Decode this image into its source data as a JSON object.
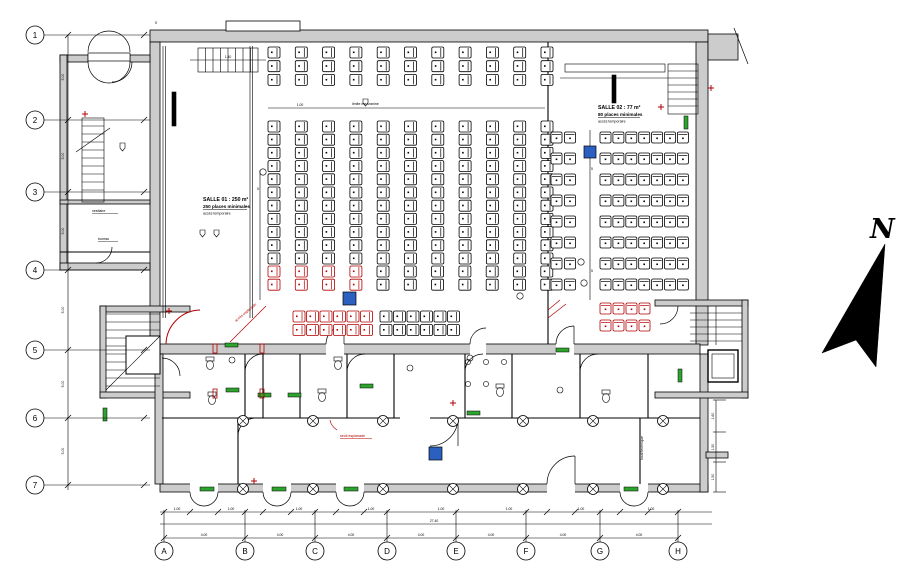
{
  "north": {
    "label": "N"
  },
  "rooms": {
    "salle01": {
      "l1": "SALLE 01 : 250 m²",
      "l2": "250 places minimales",
      "l3": "accès temporaire"
    },
    "salle02": {
      "l1": "SALLE 02 : 77 m²",
      "l2": "80 places minimales",
      "l3": "accès temporaire"
    },
    "room_small_1": "vestiaire",
    "room_small_2": "bureau",
    "mezz": "limite mezzanine",
    "tech": "local technique"
  },
  "notes": {
    "red_1": "accès esplanade",
    "red_2": "seuil esplanade"
  },
  "colors": {
    "wall": "#cccccc",
    "line": "#000000",
    "seat_red": "#b30000",
    "door_green": "#2fa32f",
    "marker_blue": "#2b5fc0"
  },
  "plan": {
    "axes": {
      "left": {
        "labels": [
          "1",
          "2",
          "3",
          "4",
          "5",
          "6",
          "7"
        ],
        "x": 35,
        "ys": [
          35,
          120,
          192,
          270,
          350,
          418,
          485
        ],
        "r": 9
      },
      "bottom": {
        "labels": [
          "A",
          "B",
          "C",
          "D",
          "E",
          "F",
          "G",
          "H"
        ],
        "y": 551,
        "xs": [
          164,
          245,
          315,
          387,
          456,
          526,
          600,
          678
        ],
        "r": 9
      }
    },
    "columns": {
      "xs": [
        243,
        313,
        383,
        453,
        523,
        593,
        663
      ],
      "ys": [
        421,
        489
      ],
      "r": 5.5
    },
    "seats": [
      {
        "x": 268,
        "y": 47,
        "cols": 11,
        "rows": 3,
        "dx": 27.3,
        "dy": 13.7,
        "w": 12,
        "h": 11,
        "dir": "v",
        "color": "black"
      },
      {
        "x": 268,
        "y": 121,
        "cols": 11,
        "rows": 11,
        "dx": 27.3,
        "dy": 13.2,
        "w": 12,
        "h": 11,
        "dir": "v",
        "color": "black"
      },
      {
        "x": 268,
        "y": 266,
        "cols": 4,
        "rows": 2,
        "dx": 27.3,
        "dy": 13.2,
        "w": 12,
        "h": 11,
        "dir": "v",
        "color": "red"
      },
      {
        "x": 377,
        "y": 266,
        "cols": 7,
        "rows": 2,
        "dx": 27.3,
        "dy": 13.2,
        "w": 12,
        "h": 11,
        "dir": "v",
        "color": "black"
      },
      {
        "x": 293,
        "y": 311,
        "cols": 2,
        "rows": 2,
        "dx": 13.5,
        "dy": 13.5,
        "w": 12,
        "h": 11,
        "dir": "v",
        "color": "red"
      },
      {
        "x": 320,
        "y": 311,
        "cols": 2,
        "rows": 2,
        "dx": 13.5,
        "dy": 13.5,
        "w": 12,
        "h": 11,
        "dir": "v",
        "color": "red"
      },
      {
        "x": 347,
        "y": 311,
        "cols": 2,
        "rows": 2,
        "dx": 13.5,
        "dy": 13.5,
        "w": 12,
        "h": 11,
        "dir": "v",
        "color": "red"
      },
      {
        "x": 380,
        "y": 311,
        "cols": 2,
        "rows": 2,
        "dx": 13.5,
        "dy": 13.5,
        "w": 12,
        "h": 11,
        "dir": "v",
        "color": "black"
      },
      {
        "x": 407,
        "y": 311,
        "cols": 2,
        "rows": 2,
        "dx": 13.5,
        "dy": 13.5,
        "w": 12,
        "h": 11,
        "dir": "v",
        "color": "black"
      },
      {
        "x": 434,
        "y": 311,
        "cols": 2,
        "rows": 2,
        "dx": 13.5,
        "dy": 13.5,
        "w": 12,
        "h": 11,
        "dir": "v",
        "color": "black"
      },
      {
        "x": 551,
        "y": 132,
        "cols": 2,
        "rows": 8,
        "dx": 13.5,
        "dy": 21,
        "w": 11,
        "h": 11,
        "dir": "h",
        "color": "black"
      },
      {
        "x": 600,
        "y": 132,
        "cols": 7,
        "rows": 8,
        "dx": 12.9,
        "dy": 21,
        "w": 11,
        "h": 11,
        "dir": "h",
        "color": "black"
      },
      {
        "x": 600,
        "y": 303,
        "cols": 4,
        "rows": 2,
        "dx": 13,
        "dy": 17,
        "w": 11,
        "h": 11,
        "dir": "h",
        "color": "red"
      }
    ],
    "dim_texts": [
      {
        "x": 204,
        "y": 536,
        "t": "4.00"
      },
      {
        "x": 280,
        "y": 536,
        "t": "4.00"
      },
      {
        "x": 351,
        "y": 536,
        "t": "4.00"
      },
      {
        "x": 421,
        "y": 536,
        "t": "4.00"
      },
      {
        "x": 491,
        "y": 536,
        "t": "4.00"
      },
      {
        "x": 563,
        "y": 536,
        "t": "4.00"
      },
      {
        "x": 639,
        "y": 536,
        "t": "4.00"
      },
      {
        "x": 177,
        "y": 510,
        "t": "1.00"
      },
      {
        "x": 231,
        "y": 510,
        "t": "1.00"
      },
      {
        "x": 299,
        "y": 510,
        "t": "1.00"
      },
      {
        "x": 371,
        "y": 510,
        "t": "1.00"
      },
      {
        "x": 441,
        "y": 510,
        "t": "1.00"
      },
      {
        "x": 509,
        "y": 510,
        "t": "1.00"
      },
      {
        "x": 581,
        "y": 510,
        "t": "1.00"
      },
      {
        "x": 651,
        "y": 510,
        "t": "1.00"
      },
      {
        "x": 434,
        "y": 522,
        "t": "27.40"
      },
      {
        "x": 64,
        "y": 77,
        "t": "5.00",
        "rot": -90
      },
      {
        "x": 64,
        "y": 156,
        "t": "5.00",
        "rot": -90
      },
      {
        "x": 64,
        "y": 231,
        "t": "5.00",
        "rot": -90
      },
      {
        "x": 64,
        "y": 310,
        "t": "5.00",
        "rot": -90
      },
      {
        "x": 64,
        "y": 384,
        "t": "5.00",
        "rot": -90
      },
      {
        "x": 64,
        "y": 451,
        "t": "5.00",
        "rot": -90
      },
      {
        "x": 714,
        "y": 416,
        "t": "1.60",
        "rot": -90
      },
      {
        "x": 714,
        "y": 447,
        "t": "1.50",
        "rot": -90
      },
      {
        "x": 714,
        "y": 477,
        "t": "1.50",
        "rot": -90
      },
      {
        "x": 258,
        "y": 190,
        "t": "5"
      },
      {
        "x": 592,
        "y": 170,
        "t": "5"
      },
      {
        "x": 592,
        "y": 272,
        "t": "5"
      },
      {
        "x": 156,
        "y": 24,
        "t": "5"
      },
      {
        "x": 228,
        "y": 58,
        "t": "1.40"
      },
      {
        "x": 300,
        "y": 106,
        "t": "1.00"
      }
    ]
  }
}
